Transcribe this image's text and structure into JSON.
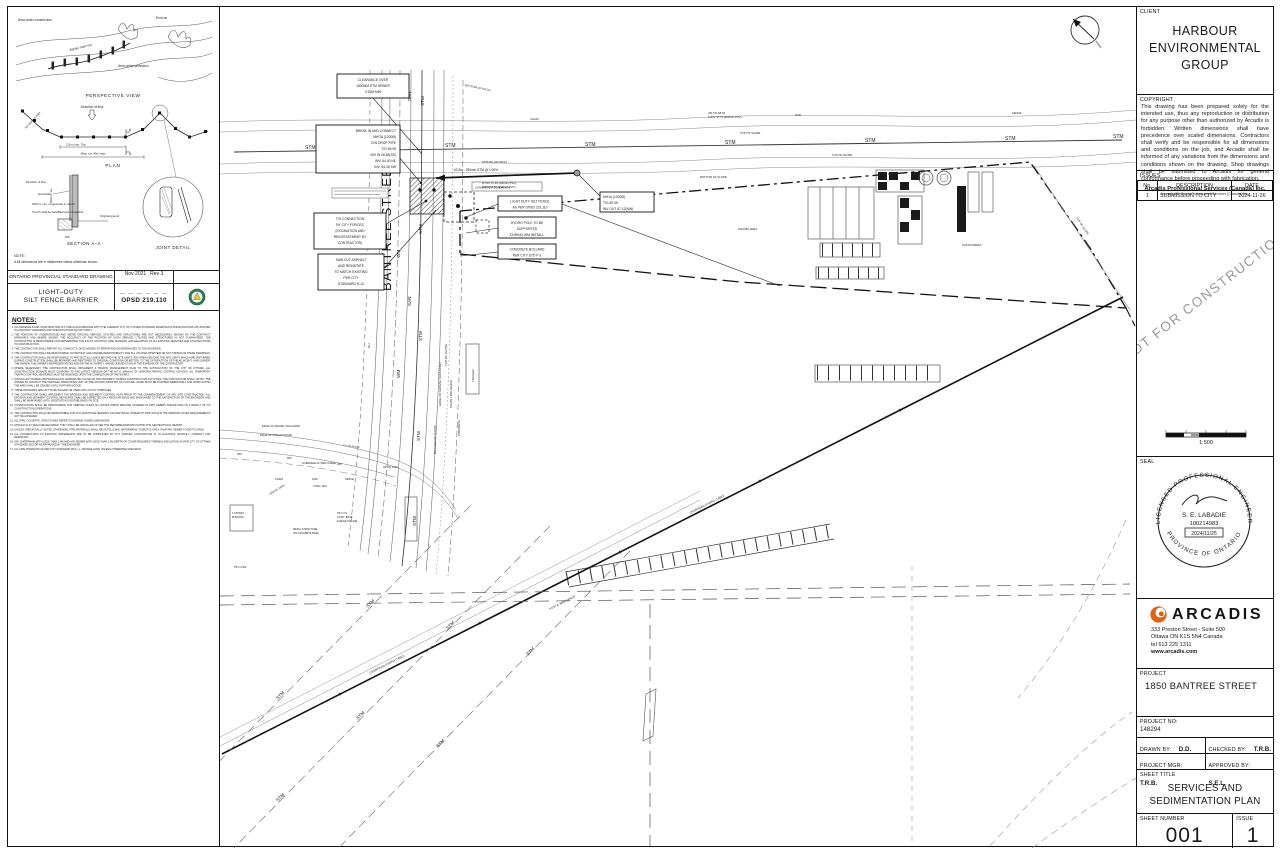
{
  "colors": {
    "line": "#1a1a1a",
    "faint": "#777777",
    "arcadis_orange": "#e4610f",
    "opsd_green": "#2a7d52",
    "opsd_yellow": "#f2c430",
    "watermark": "#9a9a9a"
  },
  "opsd": {
    "fig": {
      "area_construction": "Area under construction",
      "end_run": "End run",
      "main_run": "Barrier main run",
      "area_protection": "Area under protection",
      "perspective": "PERSPECTIVE VIEW",
      "dir_flow": "Direction of flow",
      "dim_25": "2.5m max. Typ",
      "dim_main": "Main run 40m max",
      "dim_end": "3m end run max",
      "plan": "PLAN",
      "stake": "Stake",
      "geotextile": "Geotextile",
      "geo_trench": "300mm min. of geotextile in trench",
      "trench": "Trench shall be backfilled and compacted",
      "orig_ground": "Original ground",
      "dim_600": "600mm min",
      "dim_200": "200",
      "section": "SECTION A–A",
      "joint": "JOINT DETAIL",
      "note_h": "NOTE:",
      "note_a": "A  All dimensions are in millimetres unless otherwise shown."
    },
    "header": "ONTARIO PROVINCIAL STANDARD DRAWING",
    "date": "Nov 2021",
    "rev": "Rev 3",
    "title1": "LIGHT–DUTY",
    "title2": "SILT FENCE BARRIER",
    "dashes": "— — — — — —",
    "number": "OPSD 219.110"
  },
  "notes": {
    "heading": "NOTES:",
    "items": [
      "ALL MATERIALS AND CONSTRUCTION IS TO BE IN ACCORDANCE WITH THE CURRENT CITY OF OTTAWA STANDARD DRAWINGS & SPECIFICATIONS OR UPDATED IN CONTRACT DRAWINGS AND SPECIFICATIONS DO NOT APPLY.",
      "THE POSITION OF UNDERGROUND AND ABOVE GROUND SERVICE, UTILITIES AND STRUCTURES ARE NOT NECESSARILY SHOWN ON THE CONTRACT DRAWINGS, AND WHERE SHOWN, THE ACCURACY OF THE POSITION OF SUCH SERVICE, UTILITIES AND STRUCTURES IS NOT GUARANTEED. THE CONTRACTOR IS RESPONSIBLE FOR DETERMINING THE EXACT LOCATION, SIZE, MATERIAL AND ELEVATION OF ALL EXISTING SERVICES AND UTILITIES PRIOR TO CONSTRUCTION.",
      "THE CONTRACTOR SHALL REPORT ALL CONFLICTS, DISCOVERIES OF ERROR AND DISCREPANCIES TO THE ENGINEER.",
      "THE CONTRACTOR SHALL BE RESPONSIBLE TO PROTECT AND ASSUME RESPONSIBILITY FOR ALL UTILITIES WHETHER OR NOT SHOWN ON THESE DRAWINGS.",
      "THE CONTRACTOR SHALL BE RESPONSIBLE TO PROTECT ALL LANDS BEYOND THE SITE LIMITS. ANY AREAS BEYOND THE SITE LIMITS WHICH ARE DISTURBED DURING CONSTRUCTION SHALL BE REPAIRED AND RESTORED TO ORIGINAL CONDITION OR BETTER, TO THE SATISFACTION OF THE ADJACENT LAND OWNER, THE OWNER, THE OWNER'S REPRESENTATIVES AND/OR THE AUTHORITY HAVING JURISDICTION AT THE EXPENSE OF THE CONTRACTOR.",
      "WHERE NECESSARY, THE CONTRACTOR SHALL IMPLEMENT A TRAFFIC MANAGEMENT PLAN TO THE SATISFACTION OF THE CITY OF OTTAWA. ALL CONSTRUCTION SIGNAGE MUST CONFORM TO THE LATEST VERSION OF THE M.T.O. MANUAL OF UNIFORM TRAFFIC CONTROL DEVICES. ALL TEMPORARY TRAFFIC CONTROL MEASURES MUST BE REMOVED UPON THE COMPLETION OF THE WORKS.",
      "SHOULD ANY BURIED ARCHAEOLOGICAL REMAINS BE FOUND ON THE PROPERTY DURING CONSTRUCTION ACTIVITIES, THE CONTRACTOR SHALL NOTIFY THE OWNER TO CONTACT THE HERITAGE OPERATIONS UNIT OF THE ONTARIO MINISTRY OF CULTURE. WORK MUST BE STOPPED IMMEDIATELY AND WORK WITHIN THE AREA SHALL BE CEASED UNTIL FURTHER NOTICE.",
      "THESE DRAWINGS ARE NOT TO BE SCALED OR USED FOR LAYOUT PURPOSES.",
      "THE CONTRACTOR SHALL IMPLEMENT THE EROSION AND SEDIMENT CONTROL PLAN PRIOR TO THE COMMENCEMENT OF ANY SITE CONSTRUCTION. ALL EROSION AND SEDIMENT CONTROL MEASURES SHALL BE INSPECTED ON A REGULAR BASIS AND MAINTAINED TO THE SATISFACTION OF THE ENGINEER, AND SHALL BE MAINTAINED UNTIL VEGETATION IS ESTABLISHED ON SITE.",
      "CONTRACTORS SHALL BE RESPONSIBLE FOR KEEPING CLEAN ALL ROADS WHICH BECOME COVERED IN DIRT, DEBRIS AND/OR MUD AS A RESULT OF ITS CONSTRUCTION OPERATIONS.",
      "THE CONTRACTOR SHALL BE RESPONSIBLE FOR ANY ADDITIONAL BEDDING OR ADDITIONAL STRENGTH PIPE SHOULD THE MINIMUM COVER REQUIREMENTS NOT BE ACHIEVED.",
      "ALL PIPE, CULVERTS, STRUCTURES REFER TO NOMINAL INSIDE DIMENSIONS.",
      "SHOULD CLAY SEALS BE REQUIRED, THEY SHALL BE INSTALLED AS PER THE RECOMMENDATIONS WITHIN THE GEOTECHNICAL REPORT.",
      "UNLESS SPECIFICALLY NOTED OTHERWISE, PIPE MATERIALS SHALL BE AS FOLLOWS: WATERMAINS TO BE PVC DR18, SANITARY SEWER TO BE PVC DR35.",
      "ALL CONNECTIONS TO EXISTING WATERMAINS ARE TO BE COMPLETED BY CITY FORCES. CONTRACTOR IS TO EXCAVATE, BACKFILL, COMPACT AND REINSTATE.",
      "ANY WATERMAIN WITH LESS THAN 2.4M AND ANY SEWER WITH LESS THAN 2.0M DEPTH OF COVER REQUIRES THERMAL INSULATION AS PER CITY OF OTTAWA STANDARD W22 OR AS APPROVED BY THE ENGINEER.",
      "ALL FIRE HYDRANTS AS PER CITY STANDARD W19, i.e. ORANGE CAPS UNLESS OTHERWISE SPECIFIED."
    ]
  },
  "plan": {
    "street": "BANTREE STREET",
    "lbl": {
      "stm": "STM",
      "san": "SAN",
      "wm": "WM",
      "oh": "OH",
      "g": "G",
      "chain": "CHAIN",
      "link": "LINK",
      "fence": "FENCE",
      "top_of_slope": "TOP OF SLOPE",
      "bottom_of_slope": "BOTTOM OF SLOPE",
      "bottom_of_ditch": "BOTTOM OF DITCH",
      "gravel_area": "GRAVEL AREA",
      "containers": "CONTAINERS",
      "trailer": "TRAILER",
      "concrete": "CONCRETE",
      "edge_asphalt": "EDGE OF ASPHALT ROAD",
      "edge_gravel": "EDGE OF GRAVEL SHOULDER",
      "cl_road": "C/L OF ROAD",
      "overhead": "OVERHEAD HYDRO CABLE",
      "hp_on_line": "HP ON LINE",
      "chain_link_fence": "CHAIN LINK FENCE",
      "post_wire": "POST & WIRE FENCE",
      "storey1": "1 STOREY",
      "storey2": "BUILDING",
      "metal1": "METAL STRUCTURE",
      "metal2": "ON CONCRETE BASE",
      "conc_blk": "CONC. BLK",
      "hp03a": "HP 0.3 S",
      "hp03b": "CONC. BASE",
      "hp03c": "E EDGE ON LINE",
      "hp24": "HP 2.4 SW",
      "stm_grade": "63.3m - 250mm STM @ 1.00%",
      "mh_lid": "STM MH LID=69.04",
      "mh_winv": "W INV 67.45 (250mm PVC)",
      "mh_einv": "E INV 67.37 (250mm PVC)",
      "cb": "CB T/G 68.63",
      "cb_inv": "S INV 67.71 (200mm PVC)",
      "conc_found": "CONCRETE FOUNDATION"
    },
    "callouts": {
      "c1": [
        "CLEARANCE OVER",
        "1500MM STM SEWER",
        "0.25M MIN"
      ],
      "c2": [
        "BREAK IN AND CONNECT",
        "MHOA (1200Ø)",
        "C/W DROP PIPE",
        "T/G 69.05",
        "INV IN 66.63(SE)",
        "INV: 64.40 NE",
        "INV: 64.40 SW"
      ],
      "c3": [
        "T/S CONNECTION",
        "BY CITY FORCES",
        "(EXCAVATION AND",
        "REINSTATEMENT BY",
        "CONTRACTOR)"
      ],
      "c4": [
        "SAW CUT ASPHALT",
        "AND REINSTATE",
        "TO MATCH EXISTING",
        "PER CITY",
        "STANDARD R-10"
      ],
      "c5": [
        "LIGHT DUTY SILT FENCE",
        "AS PER OPSD 219.110"
      ],
      "c6": [
        "HYDRO POLE TO BE",
        "SUPPORTED",
        "DURING WM INSTALL"
      ],
      "c7": [
        "CONCRETE BOLLARD",
        "PER CITY STD F-3"
      ],
      "c8": [
        "MH1A (1200Ø)",
        "T/G 69.35",
        "INV OUT 67.12(NW)"
      ]
    }
  },
  "titleblock": {
    "client": {
      "label": "CLIENT",
      "line1": "HARBOUR",
      "line2": "ENVIRONMENTAL",
      "line3": "GROUP"
    },
    "copyright": {
      "label": "COPYRIGHT",
      "body": "This drawing has been prepared solely for the intended use, thus any reproduction or distribution for any purpose other than authorized by Arcadis is forbidden. Written dimensions shall have precedence over scaled dimensions. Contractors shall verify and be responsible for all dimensions and conditions on the job, and Arcadis shall be informed of any variations from the dimensions and conditions shown on the drawing.  Shop drawings shall be submitted to Arcadis for general conformance before proceeding with fabrication.",
      "company": "Arcadis Professional Services (Canada) Inc.",
      "formerly": "formerly IBI Group Professional Services (Canada) Inc."
    },
    "issues": {
      "label": "ISSUES",
      "col_no": "No.",
      "col_desc": "DESCRIPTION",
      "col_date": "DATE",
      "row_no": "1",
      "row_desc": "SUBMISSION TO CITY",
      "row_date": "2024-11-26"
    },
    "watermark": "NOT FOR CONSTRUCTION",
    "scale": "1:500",
    "seal": {
      "label": "SEAL",
      "arc_top": "LICENSED PROFESSIONAL ENGINEER",
      "name": "S. E. LABADIE",
      "number": "100214983",
      "date": "2024/11/25",
      "arc_bottom": "PROVINCE OF ONTARIO"
    },
    "firm": {
      "name": "ARCADIS",
      "addr1": "333 Preston Street - Suite 500",
      "addr2": "Ottawa ON  K1S 5N4  Canada",
      "addr3": "tel 613 225 1311",
      "web": "www.arcadis.com"
    },
    "project": {
      "label": "PROJECT",
      "value": "1850 BANTREE STREET"
    },
    "project_no": {
      "label": "PROJECT NO:",
      "value": "148294"
    },
    "people": {
      "drawn_label": "DRAWN BY:",
      "drawn": "D.D.",
      "checked_label": "CHECKED BY:",
      "checked": "T.R.B.",
      "mgr_label": "PROJECT MGR:",
      "mgr": "T.R.B.",
      "approved_label": "APPROVED BY:",
      "approved": "S.E.L."
    },
    "sheet_title": {
      "label": "SHEET TITLE",
      "line1": "SERVICES AND",
      "line2": "SEDIMENTATION PLAN"
    },
    "sheet_number": {
      "label": "SHEET NUMBER",
      "value": "001"
    },
    "issue": {
      "label": "ISSUE",
      "value": "1"
    }
  }
}
